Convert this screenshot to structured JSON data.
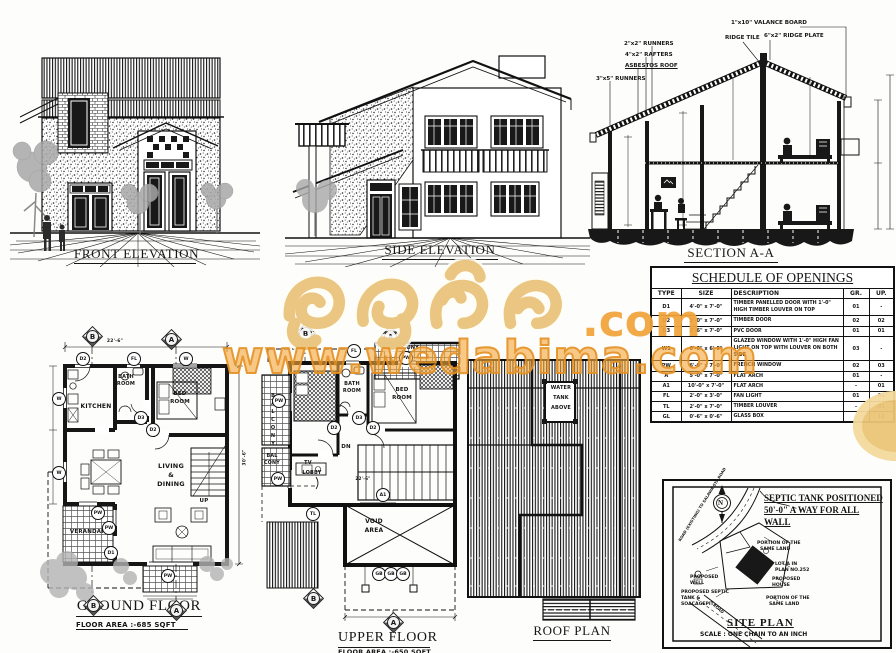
{
  "watermark": {
    "brand_sinhala": "වැඩබිම",
    "brand_suffix": ".com",
    "url": "www.wedabima.com",
    "gold": "#e9c47c",
    "orange": "#f2a43b"
  },
  "drawings": {
    "front_elevation": {
      "title": "FRONT ELEVATION"
    },
    "side_elevation": {
      "title": "SIDE ELEVATION"
    },
    "section": {
      "title": "SECTION A-A",
      "callouts": {
        "valance": "1\"x10\" VALANCE BOARD",
        "ridge_tile": "RIDGE TILE",
        "ridge_plate": "6\"x2\" RIDGE PLATE",
        "runners2": "2\"x2\" RUNNERS",
        "rafters": "4\"x2\" RAFTERS",
        "asbestos": "ASBESTOS  ROOF",
        "runners3": "3\"x5\" RUNNERS"
      }
    },
    "ground_floor": {
      "title": "GROUND FLOOR",
      "area": "FLOOR AREA :-685 SQFT",
      "dims": {
        "width": "22'-6\"",
        "depth": "30'-6\""
      },
      "rooms": {
        "kitchen": "KITCHEN",
        "bath1": "BATH",
        "bath2": "ROOM",
        "bed1": "BED",
        "bed2": "ROOM",
        "living1": "LIVING",
        "living2": "&",
        "living3": "DINING",
        "verandah": "VERANDAH",
        "up": "UP"
      },
      "markers": [
        "D2",
        "FL",
        "W",
        "W",
        "D3",
        "D2",
        "W",
        "PW",
        "PW",
        "D1",
        "PW"
      ],
      "grid_top": [
        "B",
        "A"
      ],
      "grid_bottom": [
        "B",
        "A"
      ]
    },
    "upper_floor": {
      "title": "UPPER FLOOR",
      "area": "FLOOR AREA :-650 SQFT",
      "dims": {
        "width": "22'-6\""
      },
      "rooms": {
        "balcony_top": "BALCONY",
        "balcony_left": "BALCONY",
        "bal1": "BAL",
        "bal2": "CONY",
        "bed1": "BED",
        "bed2": "ROOM",
        "bath1": "BATH",
        "bath2": "ROOM",
        "tv": "TV",
        "lobby": "LOBBY",
        "dn": "DN",
        "void1": "VOID",
        "void2": "AREA"
      },
      "markers": [
        "FL",
        "PW",
        "PW",
        "D2",
        "D3",
        "D2",
        "PW",
        "TL",
        "A1",
        "GB",
        "GB",
        "GB"
      ],
      "grid_top": [
        "B",
        "A"
      ],
      "grid_bottom": [
        "B",
        "A"
      ]
    },
    "roof_plan": {
      "title": "ROOF PLAN",
      "water_tank": [
        "WATER",
        "TANK",
        "ABOVE"
      ]
    }
  },
  "schedule": {
    "title": "SCHEDULE OF OPENINGS",
    "headers": [
      "TYPE",
      "SIZE",
      "DESCRIPTION",
      "GR.",
      "UP."
    ],
    "rows": [
      {
        "type": "D1",
        "size": "4'-0\" x 7'-0\"",
        "desc": "TIMBER PANELLED DOOR WITH 1'-0\" HIGH TIMBER LOUVER ON TOP",
        "gr": "01",
        "up": "-"
      },
      {
        "type": "D2",
        "size": "3'-0\" x 7'-0\"",
        "desc": "TIMBER DOOR",
        "gr": "02",
        "up": "02"
      },
      {
        "type": "D3",
        "size": "2'-6\" x 7'-0\"",
        "desc": "PVC DOOR",
        "gr": "01",
        "up": "01"
      },
      {
        "type": "W1",
        "size": "6'-0\" x 6'-0\"",
        "desc": "GLAZED WINDOW WITH 1'-0\" HIGH FAN LIGHT ON TOP WITH LOUVER ON BOTH SIDE",
        "gr": "03",
        "up": "-"
      },
      {
        "type": "PW",
        "size": "6'-0\" x 7'-0\"",
        "desc": "FRENCH WINDOW",
        "gr": "02",
        "up": "03"
      },
      {
        "type": "A",
        "size": "5'-0\" x 7'-0\"",
        "desc": "FLAT ARCH",
        "gr": "01",
        "up": "-"
      },
      {
        "type": "A1",
        "size": "10'-0\" x 7'-0\"",
        "desc": "FLAT ARCH",
        "gr": "-",
        "up": "01"
      },
      {
        "type": "FL",
        "size": "2'-0\" x 3'-0\"",
        "desc": "FAN LIGHT",
        "gr": "01",
        "up": "01"
      },
      {
        "type": "TL",
        "size": "2'-0\" x 7'-0\"",
        "desc": "TIMBER LOUVER",
        "gr": "-",
        "up": "01"
      },
      {
        "type": "GL",
        "size": "0'-6\" x 0'-6\"",
        "desc": "GLASS BOX",
        "gr": "-",
        "up": "12"
      }
    ]
  },
  "site_plan": {
    "note": [
      "SEPTIC TANK POSITIONED",
      "50'-0\" A WAY FOR ALL",
      "WALL"
    ],
    "compass": "N",
    "road_label": "ROAD (EXISTING) TO SALAWA STA ROAD",
    "road_label2": "ROAD",
    "labels": {
      "portion_top1": "PORTION OF THE",
      "portion_top2": "SAME LAND",
      "lot1": "LOT A IN",
      "lot2": "PLAN NO.252",
      "house1": "PROPOSED",
      "house2": "HOUSE",
      "well1": "PROPOSED",
      "well2": "WELL",
      "septic1": "PROPOSED SEPTIC",
      "septic2": "TANK &",
      "septic3": "SOACAGEPIT",
      "portion_bot1": "PORTION OF THE",
      "portion_bot2": "SAME LAND"
    },
    "title": "SITE PLAN",
    "scale": "SCALE : ONE CHAIN TO AN INCH"
  }
}
